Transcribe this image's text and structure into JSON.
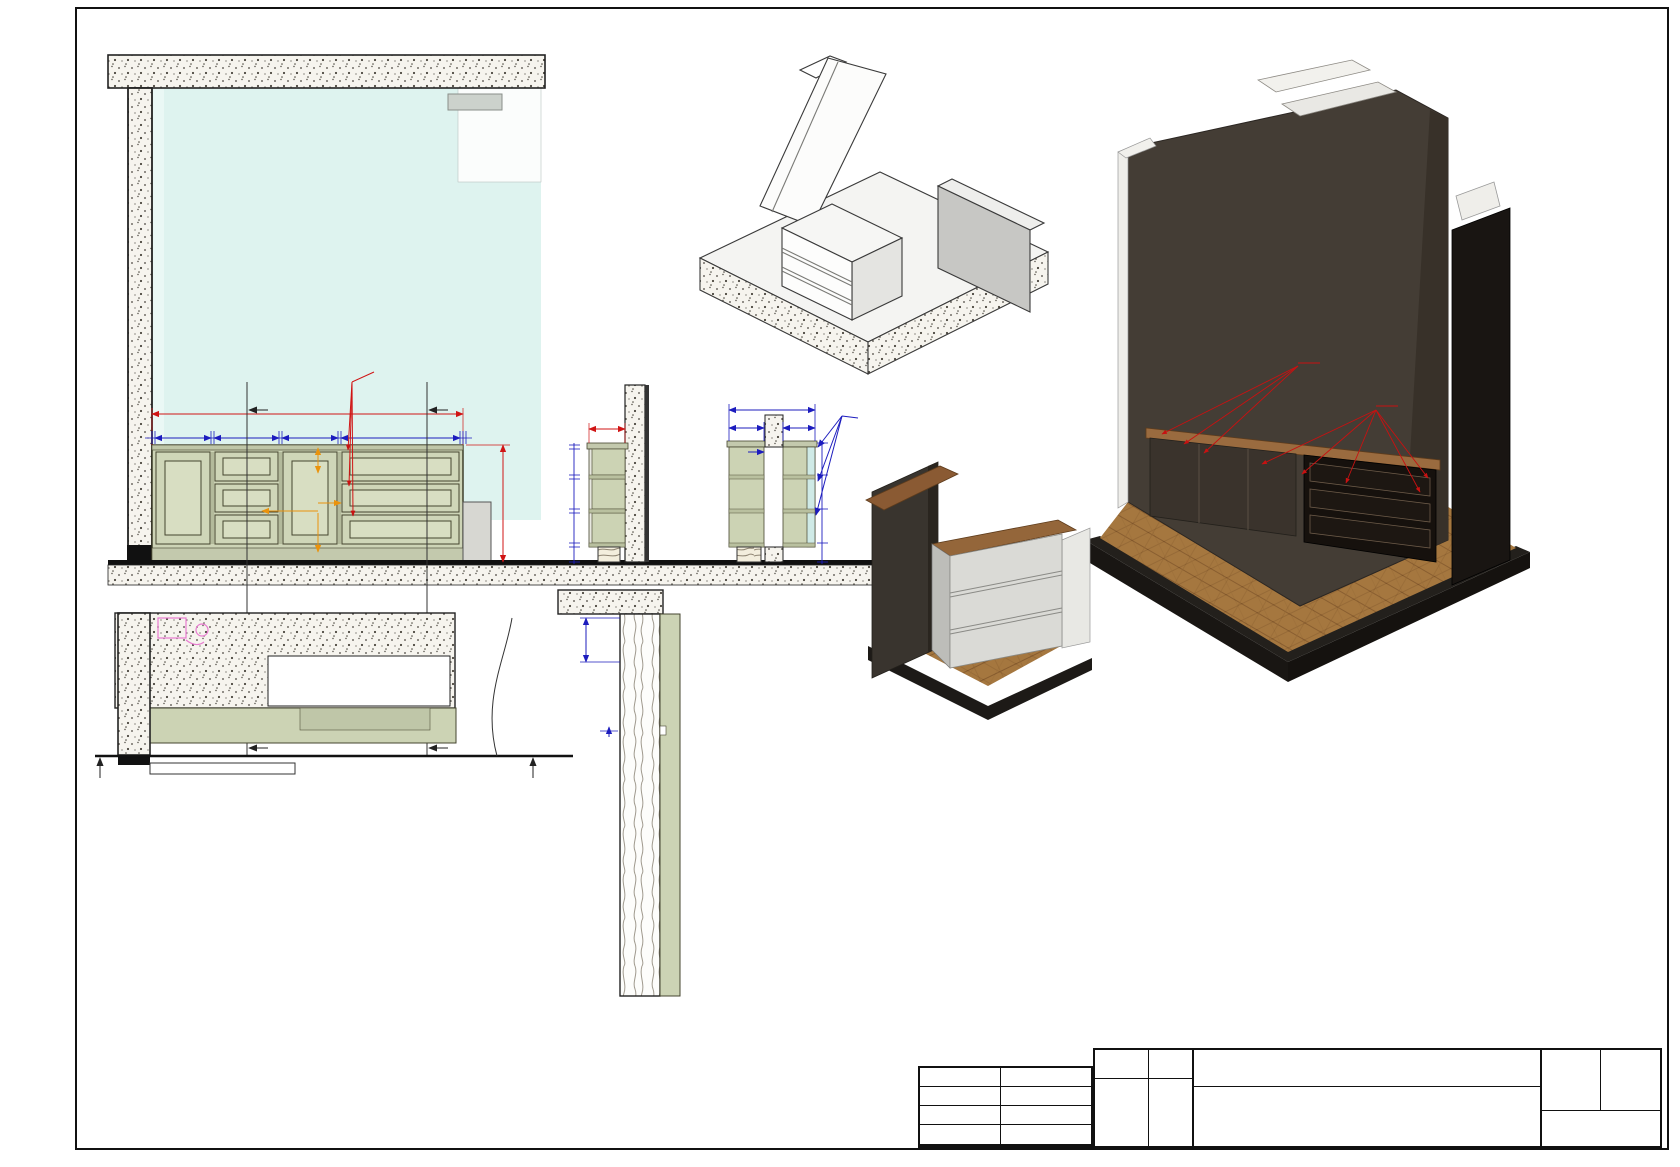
{
  "elevation": {
    "label": "Вид 04.2",
    "glass_note": "Тонированное стекло",
    "overall": "1960",
    "height": "775",
    "segments": [
      "20",
      "350",
      "20",
      "410",
      "20",
      "350",
      "20",
      "750",
      "20",
      "15"
    ],
    "inner_top50": "50",
    "inner_mid50": "50",
    "inner_750": "750",
    "inner_bot50": "50",
    "sec_a": "А",
    "sec_b": "Б"
  },
  "section_a": {
    "label": "Разрез А",
    "width": "215",
    "stack": [
      "25",
      "175",
      "25",
      "200",
      "25",
      "200",
      "25",
      "100"
    ]
  },
  "section_b": {
    "label": "Разрез Б",
    "total": "535",
    "seg1": "215",
    "seg2": "200",
    "inner20": "20",
    "right": [
      "40",
      "40",
      "40",
      "100"
    ],
    "vent": "Щели для вентиляции"
  },
  "plan": {
    "label": "04.5 Фр 04.2",
    "mark_left": "04.2",
    "mark_right": "04.2",
    "a": "А",
    "b": "Б"
  },
  "facade": {
    "label": "Разрез фасада",
    "d50": "50",
    "d5": "5"
  },
  "views": {
    "front": "Вид спереди",
    "back": "Вид сзади",
    "ann1": "тип 1",
    "ann2": "тип 3"
  },
  "titleblock": {
    "url1": "www.design17.r",
    "url2": "u",
    "rows": [
      {
        "label": "Архитектор",
        "value": ""
      },
      {
        "label": "Руководит.",
        "value": "Халитов И.Р."
      },
      {
        "label": "Заказчик",
        "value": "Стугарев А.Ю."
      }
    ],
    "sign": "Подпись",
    "date": "Дата",
    "project": "3х комнатная квартира",
    "address": "г.Москва, Погонный пр., 3А, корп.2, кв.298",
    "element": "Элемент 04",
    "sheet_label": "Лист",
    "sheet_value": "Ст.2",
    "scale_label": "Масштаб",
    "scale_value1": "Как",
    "scale_value2": "указано",
    "logo": "M17"
  }
}
